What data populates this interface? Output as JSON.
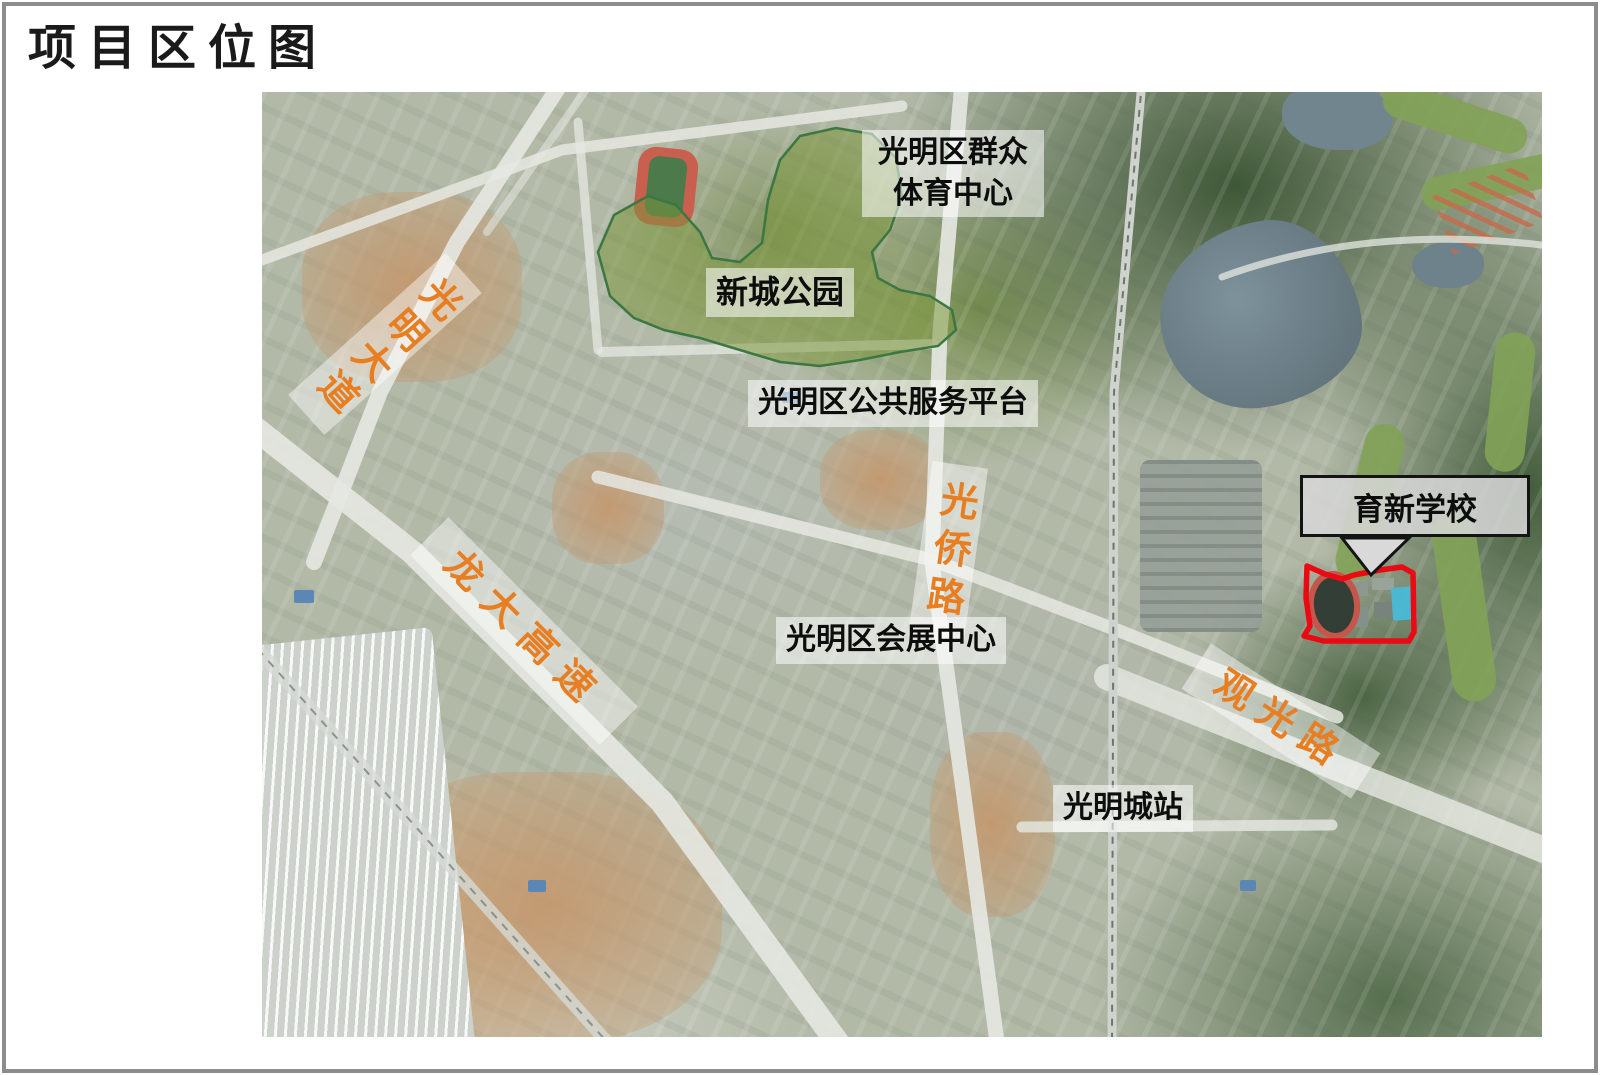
{
  "page": {
    "title": "项目区位图"
  },
  "map_labels": {
    "sports_center": "光明区群众体育中心",
    "park": "新城公园",
    "public_service": "光明区公共服务平台",
    "convention_center": "光明区会展中心",
    "station": "光明城站",
    "school": "育新学校"
  },
  "road_labels": {
    "guangming_avenue": "光明大道",
    "longda_expressway": "龙大高速",
    "guangqiao_road": "光侨路",
    "guanguang_road": "观光路"
  },
  "colors": {
    "road_label_orange": "#E87E22",
    "school_outline_red": "#EA0A14",
    "park_overlay_green": "#7A963A",
    "callout_fill_gray": "#D7D7D7",
    "label_background_white": "rgba(255,255,255,0.55)"
  }
}
